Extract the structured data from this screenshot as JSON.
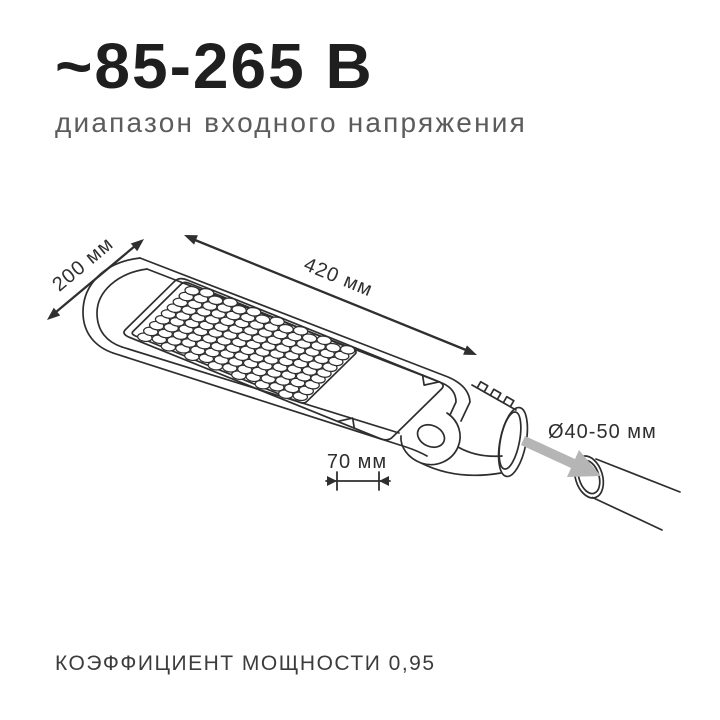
{
  "header": {
    "title": "~85-265 В",
    "subtitle": "диапазон входного напряжения"
  },
  "dimensions": {
    "width": "200 мм",
    "length": "420 мм",
    "bracket": "70 мм",
    "pole_diameter": "Ø40-50 мм"
  },
  "footer": {
    "power_factor": "КОЭФФИЦИЕНТ МОЩНОСТИ 0,95"
  },
  "led": {
    "rows": 9,
    "cols": 14
  },
  "colors": {
    "ink": "#1f1f1f",
    "line": "#2e2e2e",
    "muted_text": "#5c5c5c",
    "footer_text": "#3c3c3c",
    "dim_text": "#2f2f2f",
    "arrow_gray": "#b5b5b5"
  }
}
